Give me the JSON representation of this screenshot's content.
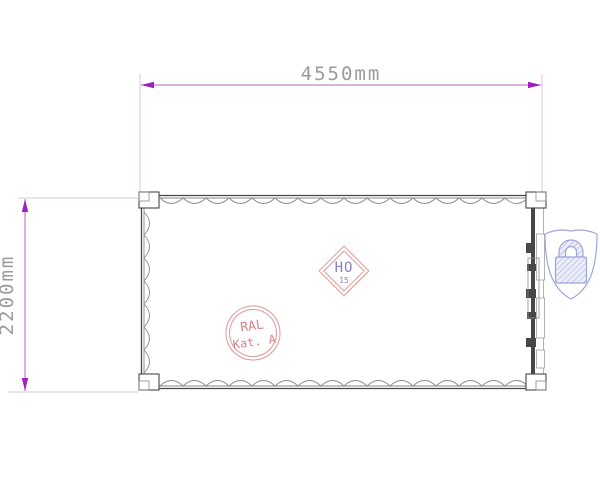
{
  "drawing": {
    "title": "container-top-view-technical-drawing",
    "dimensions": {
      "width": {
        "label": "4550mm"
      },
      "height": {
        "label": "2200mm"
      }
    }
  },
  "stamps": {
    "ho": {
      "line1": "HO",
      "line2": "15"
    },
    "ral": {
      "line1": "RAL",
      "line2": "Kat. A"
    }
  },
  "icons": {
    "security": "lock-shield-icon"
  },
  "colors": {
    "dimension_line": "#b765b7",
    "dimension_arrow": "#9c20c2",
    "dimension_text": "#9a9a9a",
    "extension_line": "#d5b3d5",
    "outline_dark": "#474747",
    "outline_mid": "#8a8a8a",
    "outline_light": "#ababab",
    "stamp_pink": "#dda1a1",
    "stamp_text_blue": "#8282c4",
    "stamp_text_purple": "#9a7ec0",
    "stamp_text_pink": "#d58585",
    "lock_lavender": "#9fa5da"
  }
}
